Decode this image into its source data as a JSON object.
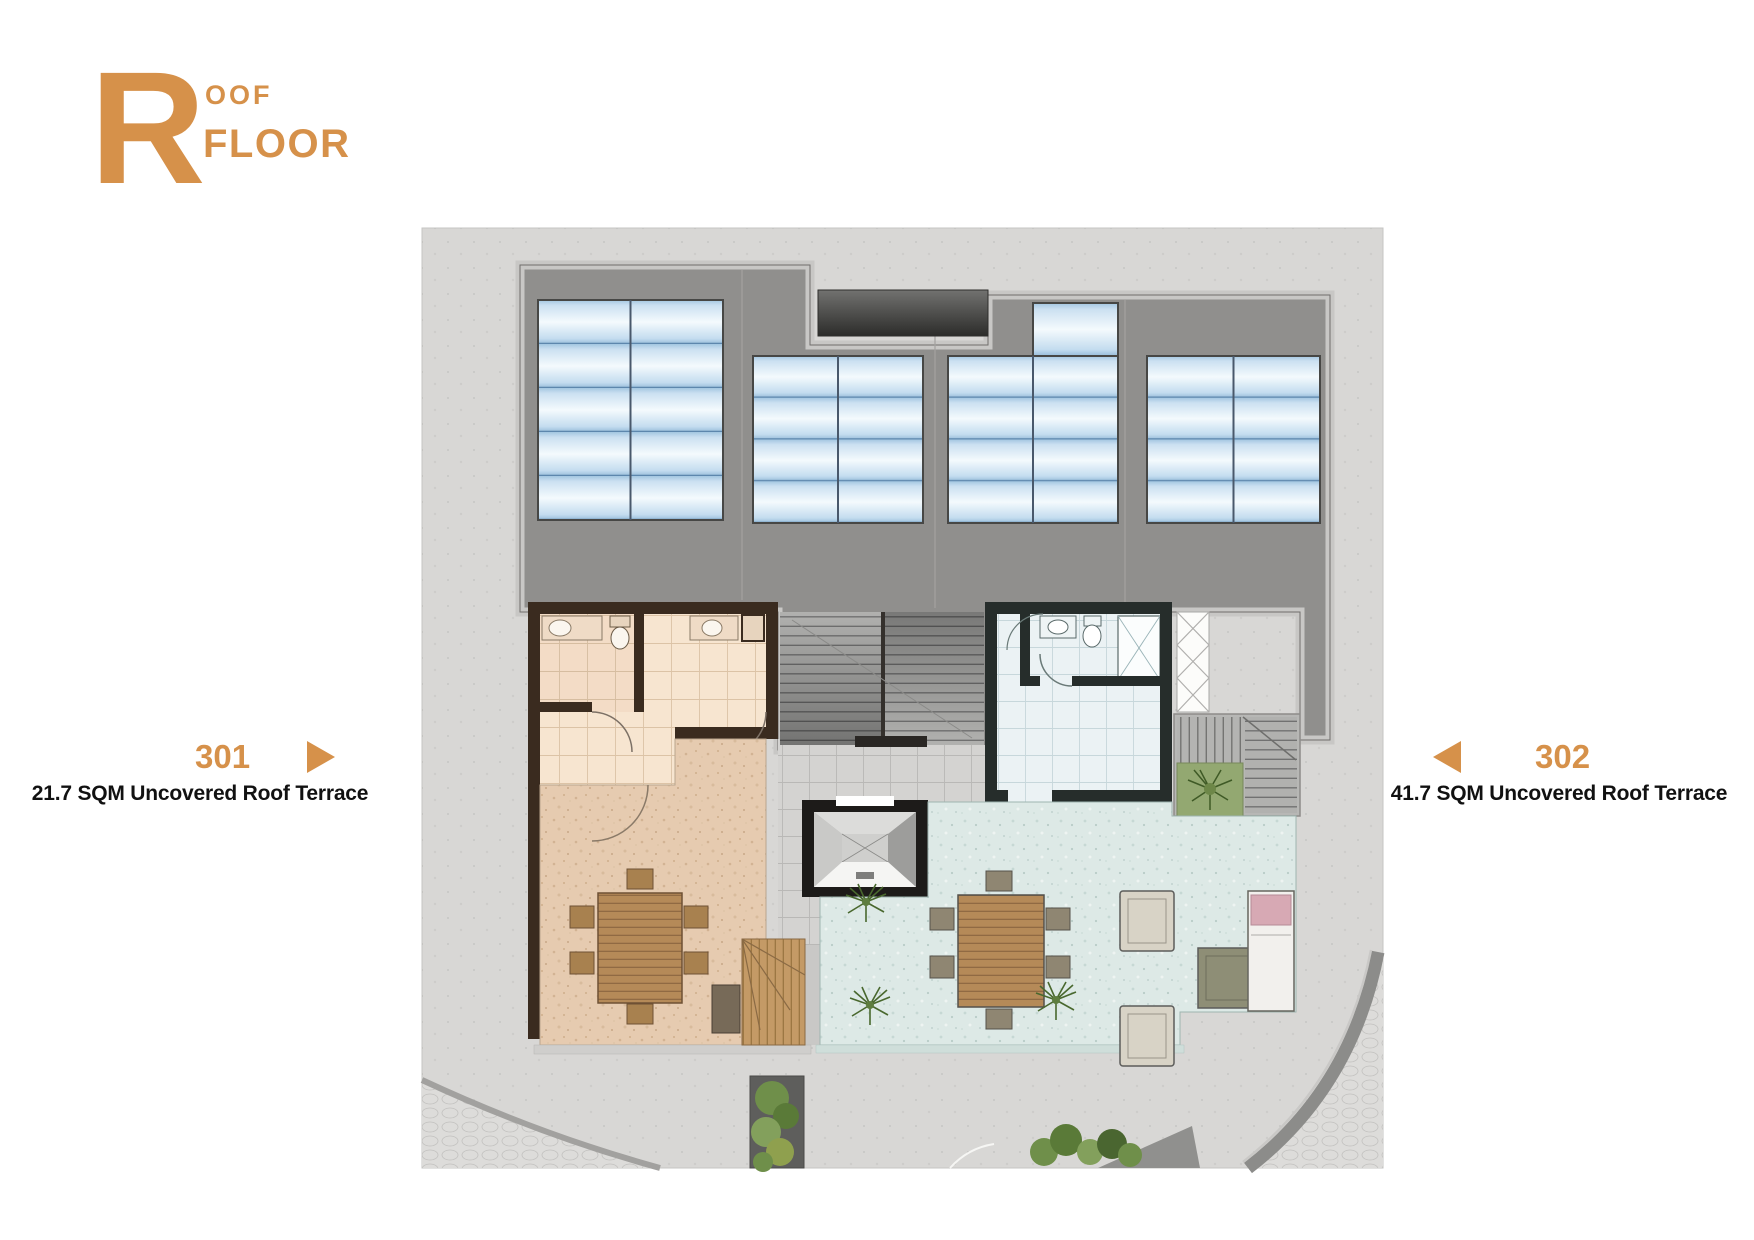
{
  "title": {
    "initial": "R",
    "word_top": "OOF",
    "word_bottom": "FLOOR"
  },
  "units": [
    {
      "number": "301",
      "description": "21.7 SQM Uncovered Roof Terrace",
      "arrow_direction": "right",
      "plan_color": "peach"
    },
    {
      "number": "302",
      "description": "41.7 SQM Uncovered Roof Terrace",
      "arrow_direction": "left",
      "plan_color": "light-blue"
    }
  ],
  "solar_panels": {
    "groups": [
      {
        "columns": 2,
        "rows": 5
      },
      {
        "columns": 2,
        "rows": 4
      },
      {
        "columns": 2,
        "rows": 4,
        "extra_top_cells": 1
      },
      {
        "columns": 2,
        "rows": 4
      }
    ]
  },
  "colors": {
    "accent": "#D6914A",
    "label_text": "#111111",
    "plan_background": "#D8D7D5",
    "roof_slab": "#908F8D",
    "solar_panel_blue": "#BDD8EC",
    "unit301_walls": "#3A2B1F",
    "unit301_floor": "#F7E5D0",
    "unit301_terrace": "#E6CBB0",
    "unit302_walls": "#262D2B",
    "unit302_floor": "#EBF2F4",
    "unit302_terrace": "#DDE9E6"
  }
}
